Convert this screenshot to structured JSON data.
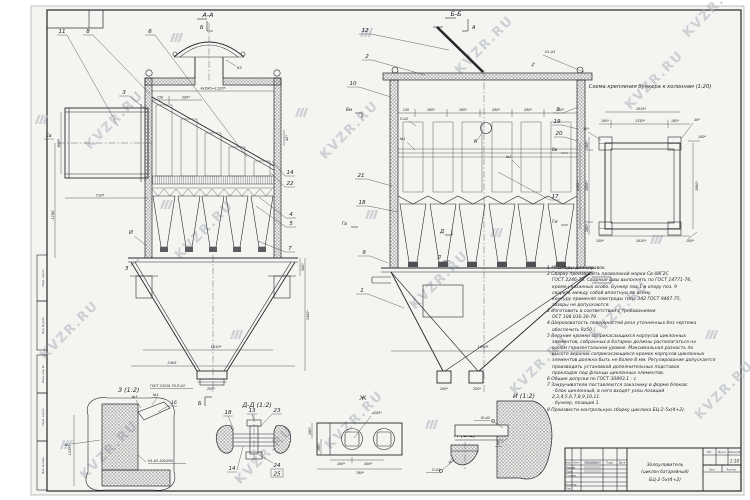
{
  "watermark": {
    "text": "KVZR.RU"
  },
  "sections": {
    "aa": "А-А",
    "bb": "Б-Б",
    "a": "А",
    "b": "Б"
  },
  "marks": {
    "ev": "Ев",
    "vm": "Вм",
    "vv": "Вв",
    "gv": "Гв",
    "gm": "Гм",
    "k": "К",
    "d": "Д",
    "l": "Л",
    "i": "И",
    "z": "З",
    "k2": "К2",
    "k4": "К4",
    "n1": "№1",
    "n2": "№2",
    "n3": "№3",
    "n4": "№4",
    "pd3": "П-Δ3",
    "n1d4": "Н1-Δ4",
    "ud5": "Ю-Δ5",
    "gost": "ГОСТ 23518-79-П-Δ3",
    "weld_step": "Н1-Δ3-100/200"
  },
  "callouts": {
    "c1": "1",
    "c2": "2",
    "c3": "3",
    "c4": "4",
    "c5": "5",
    "c6": "6",
    "c7": "7",
    "c8": "8",
    "c9": "9",
    "c10": "10",
    "c11": "11",
    "c12": "12",
    "c13": "13",
    "c14": "14",
    "c16": "16",
    "c17": "17",
    "c18": "18",
    "c19": "19",
    "c20": "20",
    "c21": "21",
    "c22": "22",
    "c23": "23",
    "c24": "24",
    "c25": "25"
  },
  "dims": {
    "row": "4х280=1120*",
    "d150": "150",
    "d280": "280*",
    "d42": "42*",
    "d600": "600*",
    "d710": "710*",
    "d1190": "1190",
    "d2405": "2405",
    "d1610": "1610*",
    "d200": "200*",
    "d300": "300*",
    "d1400": "1400*",
    "d1890": "1890*",
    "d123": "123*",
    "d160": "160*",
    "d180": "180*",
    "d400": "400*",
    "d760": "760*",
    "dia282": "⌀282*",
    "d1810": "1810*",
    "d1330": "1330*",
    "d40": "40*",
    "d100": "100*",
    "d2080": "2080*",
    "d1650": "1650*",
    "d1880": "1880*"
  },
  "scheme": {
    "title": "Схема крепления бункера к колоннам (1:20)"
  },
  "details": {
    "z": "З (1:2)",
    "dd": "Д-Д (1:2)",
    "zh": "Ж",
    "k": "К (1:2)",
    "i": "И (1:2)",
    "five": "5"
  },
  "notes": {
    "lines": [
      "1 *Размеры для справок.",
      "2 Сварку производить проволокой марки Св-08Г2С",
      "ГОСТ 2246-70. Сварные швы выполнять по ГОСТ 14771-76,",
      "кроме указанных особо. Бункер поз.1 и опору поз. 9",
      "сварить между собой вплотную по всему",
      "контуру применяя электроды типа Э42 ГОСТ 9467-75,",
      "зазоры не допускаются.",
      "3 Изготовить в соответствии с требованиями",
      "ОСТ 108.030.30-79.",
      "4 Шероховатость поверхностей реза уточненных без чертежа",
      "обеспечить Rz50.",
      "5 Верхние кромки соприкасающихся корпусов циклонных",
      "элементов, собранных в батарею должны располагаться на",
      "одном горизонтальном уровне. Максимальная разность по",
      "высоте верхних соприкасающихся кромок корпусов циклонных",
      "элементов должна быть не более 8 мм. Регулирование допускается",
      "производить установкой дополнительных подставок",
      "прокладок под фланцы циклонных элементов.",
      "6 Общие допуски по ГОСТ 30893.1 - с",
      "7 Закручиватели поставляются заказчику в форме блоков:",
      "- блок циклонный, в него входят узлы позиций",
      "2,3,4,5,6,7,8,9,10,11.",
      "- бункер, позиция 1.",
      "8 Произвести контрольную сборку циклона БЦ-2-5х(4+2)."
    ]
  },
  "title_block": {
    "product1": "Золоуловитель",
    "product2": "(циклон батарейный)",
    "product3": "БЦ-2-5х(4+2)",
    "scale": "1:10",
    "h_izm": "Изм.",
    "h_list": "Лист",
    "h_doc": "№ докум.",
    "h_podp": "Подп.",
    "h_data": "Дата",
    "r1": "Разраб.",
    "r2": "Пров.",
    "r3": "Т.контр.",
    "r4": "Н.контр.",
    "r5": "Утв.",
    "lit": "Лит.",
    "massa": "Масса",
    "scale_lbl": "Масштаб",
    "list": "Лист",
    "listov": "Листов"
  },
  "stamps": {
    "s1": "Подп. и дата",
    "s2": "Инв. № дубл.",
    "s3": "Взам. инв. №",
    "s4": "Подп. и дата",
    "s5": "Инв. № подл."
  }
}
